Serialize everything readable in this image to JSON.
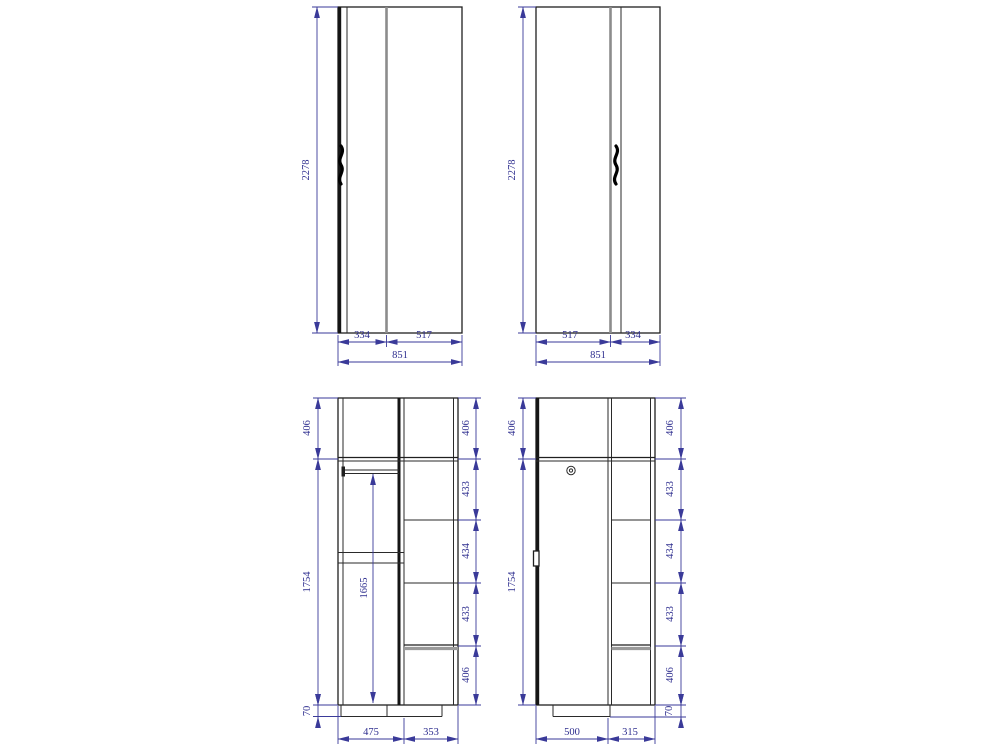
{
  "drawing_type": "wardrobe-technical-drawing",
  "colors": {
    "background": "#ffffff",
    "outline": "#1f1f1f",
    "panel_gray": "#8c8c8c",
    "dimension_blue": "#3a3a99",
    "dimension_text": "#2e2e8f"
  },
  "icons": {
    "door_handle": "door-handle-icon",
    "lock": "lock-icon"
  },
  "views": {
    "front_left": {
      "height": "2278",
      "widths": [
        "334",
        "517"
      ],
      "total_width": "851"
    },
    "front_right": {
      "height": "2278",
      "widths": [
        "517",
        "334"
      ],
      "total_width": "851"
    },
    "interior_left": {
      "top_height": "406",
      "body_height": "1754",
      "plinth_height": "70",
      "rail_drop": "1665",
      "right_heights": [
        "406",
        "433",
        "434",
        "433",
        "406"
      ],
      "bottom_widths": [
        "475",
        "353"
      ]
    },
    "interior_right": {
      "top_height": "406",
      "door_height": "1754",
      "plinth_height": "70",
      "right_heights": [
        "406",
        "433",
        "434",
        "433",
        "406"
      ],
      "bottom_widths": [
        "500",
        "315"
      ]
    }
  }
}
